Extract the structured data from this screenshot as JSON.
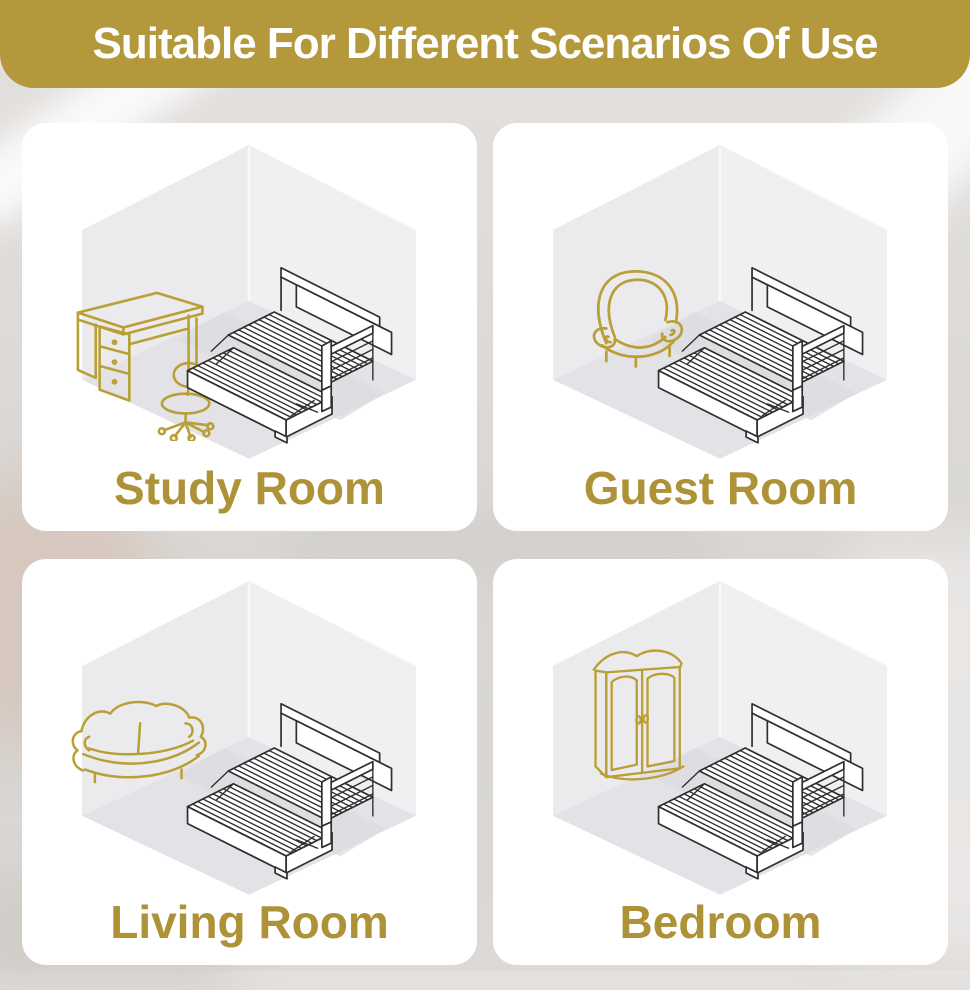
{
  "header": {
    "title": "Suitable For Different Scenarios Of Use"
  },
  "panels": [
    {
      "id": "study-room",
      "label": "Study Room",
      "accent_icon": "desk-and-stool-icon",
      "product_icon": "daybed-trundle-icon"
    },
    {
      "id": "guest-room",
      "label": "Guest Room",
      "accent_icon": "armchair-icon",
      "product_icon": "daybed-trundle-icon"
    },
    {
      "id": "living-room",
      "label": "Living Room",
      "accent_icon": "sofa-icon",
      "product_icon": "daybed-trundle-icon"
    },
    {
      "id": "bedroom",
      "label": "Bedroom",
      "accent_icon": "wardrobe-icon",
      "product_icon": "daybed-trundle-icon"
    }
  ],
  "colors": {
    "gold-banner": "#b3993c",
    "gold-label": "#ad9238",
    "gold-line": "#b99f36",
    "bed-line": "#2f2f2f",
    "wall-left": "#ebebee",
    "wall-right": "#f0f0f3",
    "floor": "#e3e3e7",
    "card-bg": "#ffffff"
  }
}
